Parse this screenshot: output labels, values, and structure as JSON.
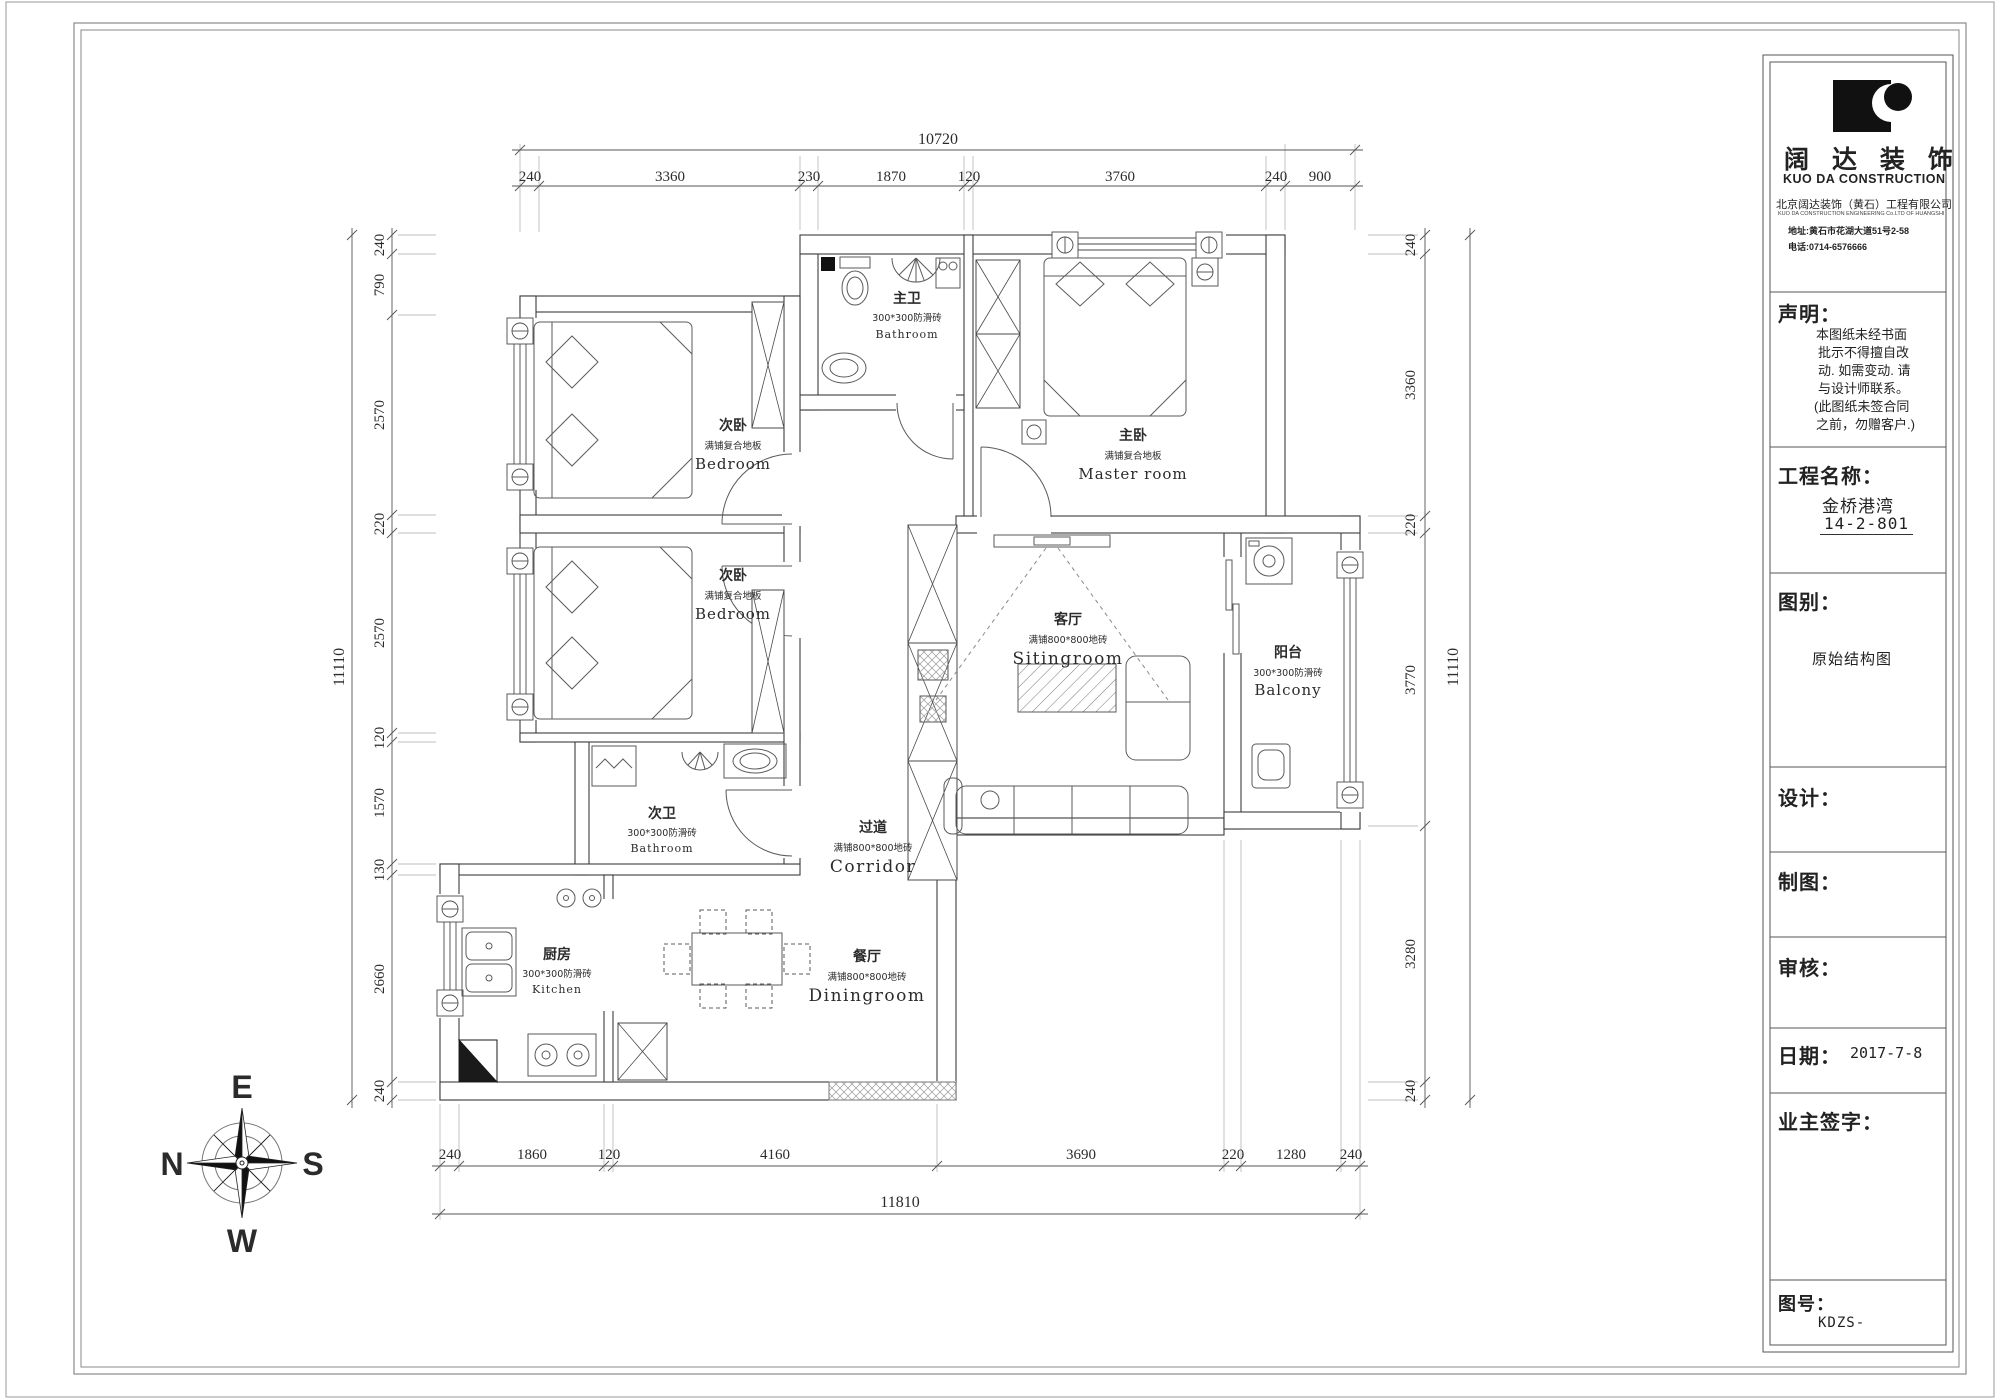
{
  "sheet": {
    "kind": "floor-plan-drawing"
  },
  "title_block": {
    "brand_cn": "阔 达 装 饰",
    "brand_en": "KUO DA CONSTRUCTION",
    "company_cn": "北京阔达装饰（黄石）工程有限公司",
    "company_en": "KUO DA CONSTRUCTION ENGINEERING Co.LTD OF HUANGSHI",
    "address": "地址:黄石市花湖大道51号2-58",
    "phone": "电话:0714-6576666",
    "statement_label": "声明：",
    "statement_lines": [
      "本图纸未经书面",
      "批示不得擅自改",
      "动. 如需变动. 请",
      "与设计师联系。",
      "(此图纸未签合同",
      "之前，勿赠客户.)"
    ],
    "project_label": "工程名称：",
    "project_name": "金桥港湾",
    "project_no": "14-2-801",
    "type_label": "图别：",
    "type_value": "原始结构图",
    "designer_label": "设计：",
    "drafter_label": "制图：",
    "auditor_label": "审核：",
    "date_label": "日期：",
    "date_value": "2017-7-8",
    "owner_label": "业主签字：",
    "no_label": "图号：",
    "no_value": "KDZS-"
  },
  "compass": {
    "e": "E",
    "s": "S",
    "w": "W",
    "n": "N"
  },
  "rooms": [
    {
      "cn": "次卧",
      "finish": "满铺复合地板",
      "en": "Bedroom"
    },
    {
      "cn": "次卧",
      "finish": "满铺复合地板",
      "en": "Bedroom"
    },
    {
      "cn": "主卧",
      "finish": "满铺复合地板",
      "en": "Master room"
    },
    {
      "cn": "主卫",
      "finish": "300*300防滑砖",
      "en": "Bathroom"
    },
    {
      "cn": "次卫",
      "finish": "300*300防滑砖",
      "en": "Bathroom"
    },
    {
      "cn": "客厅",
      "finish": "满铺800*800地砖",
      "en": "Sitingroom"
    },
    {
      "cn": "阳台",
      "finish": "300*300防滑砖",
      "en": "Balcony"
    },
    {
      "cn": "过道",
      "finish": "满铺800*800地砖",
      "en": "Corridor"
    },
    {
      "cn": "厨房",
      "finish": "300*300防滑砖",
      "en": "Kitchen"
    },
    {
      "cn": "餐厅",
      "finish": "满铺800*800地砖",
      "en": "Diningroom"
    }
  ],
  "dimensions": {
    "top": {
      "overall": "10720",
      "segments": [
        "240",
        "3360",
        "230",
        "1870",
        "120",
        "3760",
        "240",
        "900"
      ]
    },
    "bottom": {
      "overall": "11810",
      "segments": [
        "240",
        "1860",
        "120",
        "4160",
        "3690",
        "220",
        "1280",
        "240"
      ]
    },
    "left": {
      "overall": "11110",
      "segments": [
        "240",
        "790",
        "2570",
        "220",
        "2570",
        "120",
        "1570",
        "130",
        "2660",
        "240"
      ]
    },
    "right": {
      "overall": "11110",
      "segments": [
        "240",
        "3360",
        "220",
        "3770",
        "3280",
        "240"
      ]
    }
  },
  "colors": {
    "wall": "#3c3c3c",
    "furniture": "#5a5a5a",
    "dim": "#444444",
    "frame": "#8a8a8a",
    "accent_black": "#111111"
  }
}
